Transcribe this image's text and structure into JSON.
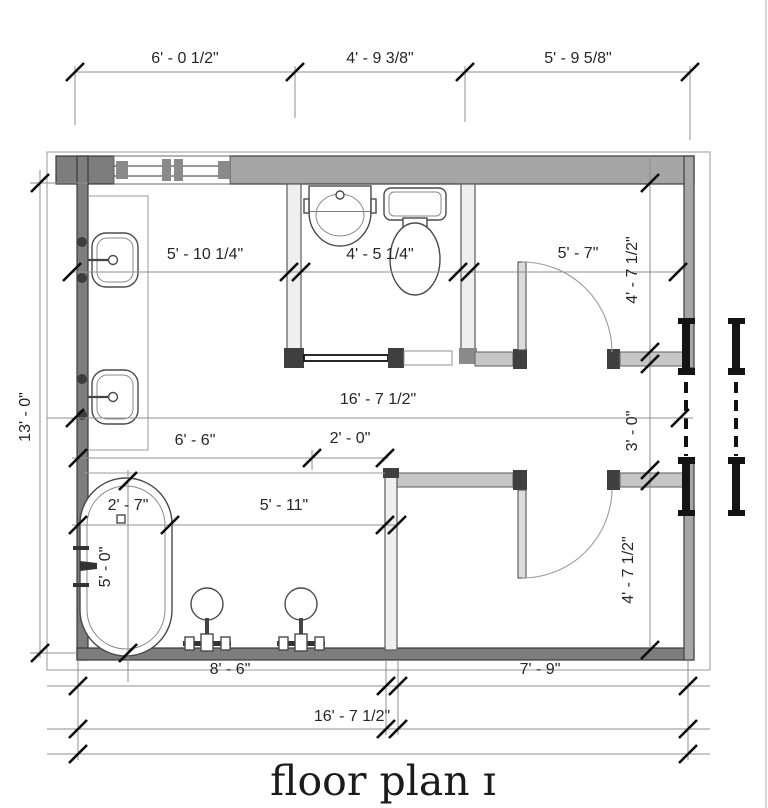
{
  "title": "floor plan ɪ",
  "dimensions": {
    "top_left": "6' - 0 1/2\"",
    "top_middle": "4' - 9 3/8\"",
    "top_right": "5' - 9 5/8\"",
    "overall_height": "13' - 0\"",
    "vanity_wall": "5' - 10 1/4\"",
    "water_closet_width": "4' - 5 1/4\"",
    "right_room_width": "5' - 7\"",
    "right_room_depth": "4' - 7 1/2\"",
    "overall_width_middle": "16' - 7 1/2\"",
    "passage_width": "3' - 0\"",
    "tub_zone_width": "6' - 6\"",
    "opening_width": "2' - 0\"",
    "tub_width": "2' - 7\"",
    "wet_room_span": "5' - 11\"",
    "tub_length": "5' - 0\"",
    "closet_depth": "4' - 7 1/2\"",
    "bottom_left": "8' - 6\"",
    "bottom_right": "7' - 9\"",
    "overall_width": "16' - 7 1/2\""
  },
  "colors": {
    "wall_fill": "#a6a6a6",
    "wall_edge": "#474747",
    "dim_line": "#8f8f8f",
    "tick": "#0d0d0d",
    "text": "#262626"
  }
}
